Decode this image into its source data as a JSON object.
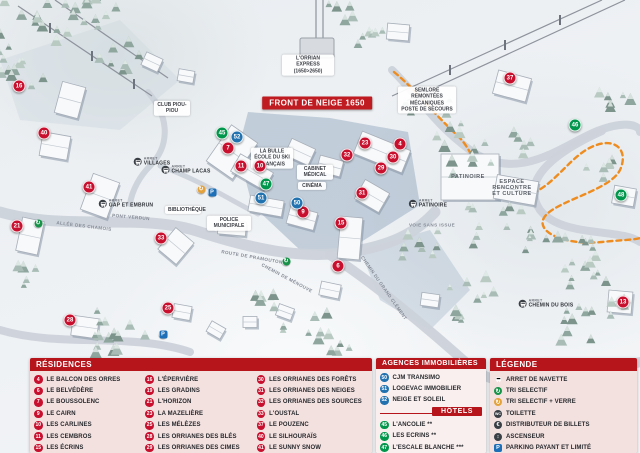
{
  "map": {
    "banner": "FRONT DE NEIGE 1650",
    "labels": [
      {
        "cls": "box",
        "text": "L'ORRIAN EXPRESS (1650>2650)",
        "x": 308,
        "y": 65,
        "w": 46
      },
      {
        "cls": "box",
        "text": "SEMLORE REMONTÉES MÉCANIQUES POSTE DE SECOURS",
        "x": 427,
        "y": 100,
        "w": 52
      },
      {
        "cls": "box",
        "text": "CLUB PIOU-PIOU",
        "x": 172,
        "y": 108,
        "w": 30
      },
      {
        "cls": "box",
        "text": "LA BULLE ÉCOLE DU SKI FRANÇAIS",
        "x": 272,
        "y": 158,
        "w": 36
      },
      {
        "cls": "box",
        "text": "CABINET MÉDICAL",
        "x": 315,
        "y": 172,
        "w": 30
      },
      {
        "cls": "box",
        "text": "CINÉMA",
        "x": 312,
        "y": 186,
        "w": 22
      },
      {
        "cls": "box",
        "text": "POLICE MUNICIPALE",
        "x": 229,
        "y": 223,
        "w": 38
      },
      {
        "cls": "box",
        "text": "BIBLIOTHÈQUE",
        "x": 183,
        "y": 210,
        "w": 30
      },
      {
        "cls": "plain",
        "text": "PATINOIRE",
        "x": 468,
        "y": 177,
        "w": 40
      },
      {
        "cls": "plain",
        "text": "ESPACE RENCONTRE ET CULTURE",
        "x": 512,
        "y": 188,
        "w": 44
      },
      {
        "cls": "road",
        "text": "ALLÉE DES CHAMOIS",
        "x": 84,
        "y": 226,
        "rot": 7
      },
      {
        "cls": "road",
        "text": "ROUTE DE PRAMOUTON",
        "x": 252,
        "y": 257,
        "rot": 10
      },
      {
        "cls": "road",
        "text": "CHEMIN DE MÉNOUVE",
        "x": 287,
        "y": 278,
        "rot": 28
      },
      {
        "cls": "road",
        "text": "CHEMIN DU GRAND CLÉMENT",
        "x": 384,
        "y": 288,
        "rot": 55
      },
      {
        "cls": "road",
        "text": "VOIE SANS ISSUE",
        "x": 432,
        "y": 225,
        "rot": 0
      },
      {
        "cls": "road",
        "text": "PONT VERDUN",
        "x": 131,
        "y": 217,
        "rot": 5
      }
    ],
    "bus_stops": [
      {
        "sub": "ARRET",
        "name": "CHAMP LACAS",
        "x": 186,
        "y": 170
      },
      {
        "sub": "ARRET",
        "name": "GAP ET EMBRUN",
        "x": 126,
        "y": 204
      },
      {
        "sub": "ARRET",
        "name": "VILLAGES",
        "x": 152,
        "y": 162
      },
      {
        "sub": "ARRET",
        "name": "PATINOIRE",
        "x": 428,
        "y": 204
      },
      {
        "sub": "ARRET",
        "name": "CHEMIN DU BOIS",
        "x": 546,
        "y": 304
      }
    ],
    "markers": [
      {
        "n": "16",
        "c": "red",
        "x": 19,
        "y": 86
      },
      {
        "n": "40",
        "c": "red",
        "x": 44,
        "y": 133
      },
      {
        "n": "41",
        "c": "red",
        "x": 89,
        "y": 187
      },
      {
        "n": "21",
        "c": "red",
        "x": 17,
        "y": 226
      },
      {
        "n": "28",
        "c": "red",
        "x": 70,
        "y": 320
      },
      {
        "n": "33",
        "c": "red",
        "x": 161,
        "y": 238
      },
      {
        "n": "25",
        "c": "red",
        "x": 168,
        "y": 308
      },
      {
        "n": "7",
        "c": "red",
        "x": 228,
        "y": 148
      },
      {
        "n": "11",
        "c": "red",
        "x": 241,
        "y": 166
      },
      {
        "n": "10",
        "c": "red",
        "x": 260,
        "y": 166
      },
      {
        "n": "9",
        "c": "red",
        "x": 303,
        "y": 212
      },
      {
        "n": "15",
        "c": "red",
        "x": 341,
        "y": 223
      },
      {
        "n": "6",
        "c": "red",
        "x": 338,
        "y": 266
      },
      {
        "n": "23",
        "c": "red",
        "x": 365,
        "y": 143
      },
      {
        "n": "4",
        "c": "red",
        "x": 400,
        "y": 144
      },
      {
        "n": "30",
        "c": "red",
        "x": 393,
        "y": 157
      },
      {
        "n": "29",
        "c": "red",
        "x": 381,
        "y": 168
      },
      {
        "n": "31",
        "c": "red",
        "x": 362,
        "y": 193
      },
      {
        "n": "32",
        "c": "red",
        "x": 347,
        "y": 155
      },
      {
        "n": "37",
        "c": "red",
        "x": 510,
        "y": 78
      },
      {
        "n": "13",
        "c": "red",
        "x": 623,
        "y": 302
      },
      {
        "n": "52",
        "c": "blue",
        "x": 237,
        "y": 137
      },
      {
        "n": "51",
        "c": "blue",
        "x": 261,
        "y": 198
      },
      {
        "n": "50",
        "c": "blue",
        "x": 297,
        "y": 203
      },
      {
        "n": "45",
        "c": "green",
        "x": 222,
        "y": 133
      },
      {
        "n": "47",
        "c": "green",
        "x": 266,
        "y": 184
      },
      {
        "n": "46",
        "c": "green",
        "x": 575,
        "y": 125
      },
      {
        "n": "48",
        "c": "green",
        "x": 621,
        "y": 195
      }
    ],
    "map_icons": [
      {
        "type": "recycle",
        "x": 38,
        "y": 223
      },
      {
        "type": "recycle",
        "x": 286,
        "y": 261
      },
      {
        "type": "recycle-verre",
        "x": 201,
        "y": 189
      },
      {
        "type": "parking",
        "x": 212,
        "y": 192
      },
      {
        "type": "parking",
        "x": 163,
        "y": 334
      }
    ]
  },
  "panels": {
    "residences": {
      "title": "RÉSIDENCES",
      "columns": [
        [
          {
            "n": "4",
            "label": "LE BALCON DES ORRES"
          },
          {
            "n": "6",
            "label": "LE BELVÉDÈRE"
          },
          {
            "n": "7",
            "label": "LE BOUSSOLENC"
          },
          {
            "n": "9",
            "label": "LE CAIRN"
          },
          {
            "n": "10",
            "label": "LES CARLINES"
          },
          {
            "n": "11",
            "label": "LES CEMBROS"
          },
          {
            "n": "15",
            "label": "LES ÉCRINS"
          }
        ],
        [
          {
            "n": "16",
            "label": "L'ÉPERVIÈRE"
          },
          {
            "n": "19",
            "label": "LES GRADINS"
          },
          {
            "n": "21",
            "label": "L'HORIZON"
          },
          {
            "n": "23",
            "label": "LA MAZELIÈRE"
          },
          {
            "n": "25",
            "label": "LES MÉLÈZES"
          },
          {
            "n": "28",
            "label": "LES ORRIANES DES BLÉS"
          },
          {
            "n": "29",
            "label": "LES ORRIANES DES CIMES"
          }
        ],
        [
          {
            "n": "30",
            "label": "LES ORRIANES DES FORÊTS"
          },
          {
            "n": "31",
            "label": "LES ORRIANES DES NEIGES"
          },
          {
            "n": "32",
            "label": "LES ORRIANES DES SOURCES"
          },
          {
            "n": "33",
            "label": "L'OUSTAL"
          },
          {
            "n": "37",
            "label": "LE POUZENC"
          },
          {
            "n": "40",
            "label": "LE SILHOURAÏS"
          },
          {
            "n": "41",
            "label": "LE SUNNY SNOW"
          }
        ]
      ]
    },
    "agences": {
      "title": "AGENCES IMMOBILIÈRES",
      "items": [
        {
          "n": "50",
          "label": "CJM TRANSIMO"
        },
        {
          "n": "51",
          "label": "LOGEVAC IMMOBILIER"
        },
        {
          "n": "52",
          "label": "NEIGE ET SOLEIL"
        }
      ],
      "hotels_title": "HÔTELS",
      "hotels": [
        {
          "n": "45",
          "label": "L'ANCOLIE **"
        },
        {
          "n": "46",
          "label": "LES ECRINS **"
        },
        {
          "n": "47",
          "label": "L'ESCALE BLANCHE ***"
        },
        {
          "n": "48",
          "label": "LES TRAPPEURS **"
        }
      ]
    },
    "legende": {
      "title": "LÉGENDE",
      "items": [
        {
          "icon": "bus",
          "label": "ARRET DE NAVETTE"
        },
        {
          "icon": "recycle",
          "label": "TRI SELECTIF"
        },
        {
          "icon": "recycle-verre",
          "label": "TRI SELECTIF + VERRE"
        },
        {
          "icon": "wc",
          "label": "TOILETTE"
        },
        {
          "icon": "euro",
          "label": "DISTRIBUTEUR DE BILLETS"
        },
        {
          "icon": "elevator",
          "label": "ASCENSEUR"
        },
        {
          "icon": "parking",
          "label": "PARKING PAYANT ET LIMITÉ"
        }
      ]
    }
  },
  "colors": {
    "header_red": "#b5151b",
    "marker_red": "#c8102e",
    "marker_blue": "#2272b0",
    "marker_green": "#00964b",
    "icon_dark": "#3a3f46",
    "icon_amber": "#e3a23c",
    "icon_blue": "#1d70b7",
    "route_orange": "#ef8c1f",
    "road_grey": "#ccd2da"
  }
}
